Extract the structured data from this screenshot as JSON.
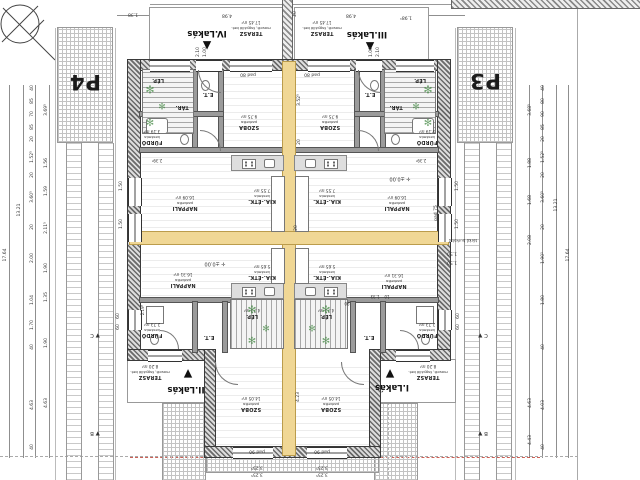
{
  "title": "Négylakásos lakóépület földszinti alaprajz (fejjel lefelé tájolt CAD rajz)",
  "parking": {
    "p4": "P4",
    "p3": "P3"
  },
  "units": [
    {
      "label": "IV.Lakás",
      "x": 207,
      "y": 33,
      "tri": "▲",
      "tx": 207,
      "ty": 46
    },
    {
      "label": "III.Lakás",
      "x": 367,
      "y": 34,
      "tri": "▲",
      "tx": 370,
      "ty": 47
    },
    {
      "label": "II.Lakás",
      "x": 186,
      "y": 389,
      "tri": "▼",
      "tx": 188,
      "ty": 374
    },
    {
      "label": "I.Lakás",
      "x": 392,
      "y": 387,
      "tri": "▼",
      "tx": 390,
      "ty": 374
    }
  ],
  "rooms": [
    {
      "name": "TERASZ",
      "mat": "mosott, fagyálló bet.",
      "area": "17.45 m²",
      "x": 251,
      "y": 28
    },
    {
      "name": "TERASZ",
      "mat": "mosott, fagyálló bet.",
      "area": "17.45 m²",
      "x": 322,
      "y": 28
    },
    {
      "name": "TERASZ",
      "mat": "mosott, fagyálló bet.",
      "area": "8.20 m²",
      "x": 150,
      "y": 372
    },
    {
      "name": "TERASZ",
      "mat": "mosott, fagyálló bet.",
      "area": "8.20 m²",
      "x": 428,
      "y": 372
    },
    {
      "name": "SZOBA",
      "mat": "parketta",
      "area": "9.75 m²",
      "x": 249,
      "y": 122
    },
    {
      "name": "SZOBA",
      "mat": "parketta",
      "area": "9.75 m²",
      "x": 330,
      "y": 122
    },
    {
      "name": "SZOBA",
      "mat": "parketta",
      "area": "14.05 m²",
      "x": 251,
      "y": 404
    },
    {
      "name": "SZOBA",
      "mat": "parketta",
      "area": "14.05 m²",
      "x": 331,
      "y": 404
    },
    {
      "name": "NAPPALI",
      "mat": "parketta",
      "area": "16.09 m²",
      "x": 185,
      "y": 203
    },
    {
      "name": "NAPPALI",
      "mat": "parketta",
      "area": "16.09 m²",
      "x": 397,
      "y": 203
    },
    {
      "name": "NAPPALI",
      "mat": "parketta",
      "area": "16.31 m²",
      "x": 183,
      "y": 280
    },
    {
      "name": "NAPPALI",
      "mat": "parketta",
      "area": "16.31 m²",
      "x": 394,
      "y": 281
    },
    {
      "name": "KIA.-ÉTK.",
      "mat": "kerámia",
      "area": "7.55 m²",
      "x": 262,
      "y": 196
    },
    {
      "name": "KIA.-ÉTK.",
      "mat": "kerámia",
      "area": "7.55 m²",
      "x": 327,
      "y": 196
    },
    {
      "name": "KIA.-ÉTK.",
      "mat": "kerámia",
      "area": "5.65 m²",
      "x": 262,
      "y": 272
    },
    {
      "name": "KIA.-ÉTK.",
      "mat": "kerámia",
      "area": "5.65 m²",
      "x": 327,
      "y": 272
    },
    {
      "name": "FÜRDŐ",
      "mat": "kerámia",
      "area": "3.19 m²",
      "x": 152,
      "y": 137
    },
    {
      "name": "FÜRDŐ",
      "mat": "kerámia",
      "area": "3.19 m²",
      "x": 427,
      "y": 137
    },
    {
      "name": "FÜRDŐ",
      "mat": "kerámia",
      "area": "2.73 m²",
      "x": 152,
      "y": 330
    },
    {
      "name": "FÜRDŐ",
      "mat": "kerámia",
      "area": "2.73 m²",
      "x": 427,
      "y": 330
    },
    {
      "name": "TÁR.",
      "mat": "",
      "area": "",
      "x": 182,
      "y": 107
    },
    {
      "name": "TÁR.",
      "mat": "",
      "area": "",
      "x": 396,
      "y": 107
    },
    {
      "name": "E.T.",
      "mat": "",
      "area": "",
      "x": 208,
      "y": 94
    },
    {
      "name": "E.T.",
      "mat": "",
      "area": "",
      "x": 370,
      "y": 94
    },
    {
      "name": "E.T.",
      "mat": "",
      "area": "",
      "x": 209,
      "y": 337
    },
    {
      "name": "E.T.",
      "mat": "",
      "area": "",
      "x": 369,
      "y": 337
    },
    {
      "name": "LÉP.",
      "mat": "",
      "area": "",
      "x": 158,
      "y": 80
    },
    {
      "name": "LÉP.",
      "mat": "",
      "area": "",
      "x": 420,
      "y": 80
    },
    {
      "name": "LÉP.",
      "mat": "",
      "area": "4.73 m²",
      "x": 252,
      "y": 313
    },
    {
      "name": "LÉP.",
      "mat": "",
      "area": "4.73 m²",
      "x": 326,
      "y": 313
    }
  ],
  "labels": [
    {
      "t": "4.98",
      "x": 227,
      "y": 14
    },
    {
      "t": "4.98",
      "x": 351,
      "y": 14
    },
    {
      "t": "1.38",
      "x": 133,
      "y": 13
    },
    {
      "t": "1.98¹",
      "x": 406,
      "y": 16
    },
    {
      "t": "20",
      "x": 296,
      "y": 14,
      "o": "v"
    },
    {
      "t": "2.10",
      "x": 199,
      "y": 52,
      "o": "v"
    },
    {
      "t": "1.00",
      "x": 206,
      "y": 52,
      "o": "v"
    },
    {
      "t": "2.10",
      "x": 379,
      "y": 52,
      "o": "v"
    },
    {
      "t": "1.00",
      "x": 372,
      "y": 52,
      "o": "v"
    },
    {
      "t": "pad 80",
      "x": 248,
      "y": 73
    },
    {
      "t": "pad 80",
      "x": 312,
      "y": 73
    },
    {
      "t": "pad 90",
      "x": 257,
      "y": 450
    },
    {
      "t": "pad 90",
      "x": 322,
      "y": 450
    },
    {
      "t": "3.25⁵",
      "x": 257,
      "y": 466
    },
    {
      "t": "3.25⁵",
      "x": 257,
      "y": 473
    },
    {
      "t": "3.25⁵",
      "x": 322,
      "y": 466
    },
    {
      "t": "3.25⁵",
      "x": 322,
      "y": 473
    },
    {
      "t": "1.50",
      "x": 122,
      "y": 186,
      "o": "v"
    },
    {
      "t": "1.50",
      "x": 122,
      "y": 224,
      "o": "v"
    },
    {
      "t": "1.50",
      "x": 458,
      "y": 186,
      "o": "v"
    },
    {
      "t": "1.50",
      "x": 458,
      "y": 224,
      "o": "v"
    },
    {
      "t": "1.50",
      "x": 452,
      "y": 252
    },
    {
      "t": "1.50",
      "x": 452,
      "y": 261
    },
    {
      "t": "60",
      "x": 119,
      "y": 316,
      "o": "v"
    },
    {
      "t": "60",
      "x": 119,
      "y": 327,
      "o": "v"
    },
    {
      "t": "60",
      "x": 459,
      "y": 316,
      "o": "v"
    },
    {
      "t": "60",
      "x": 459,
      "y": 327,
      "o": "v"
    },
    {
      "t": "3.52⁵",
      "x": 300,
      "y": 100,
      "o": "v"
    },
    {
      "t": "20",
      "x": 300,
      "y": 142,
      "o": "v"
    },
    {
      "t": "4.23",
      "x": 299,
      "y": 397,
      "o": "v"
    },
    {
      "t": "20",
      "x": 297,
      "y": 228,
      "o": "v"
    },
    {
      "t": "✛ ±0.00",
      "x": 215,
      "y": 263,
      "s": 5
    },
    {
      "t": "✛ ±0.00",
      "x": 400,
      "y": 178,
      "s": 5
    },
    {
      "t": "térkő burkolat",
      "x": 463,
      "y": 240,
      "s": 4
    },
    {
      "t": "pad 75",
      "x": 437,
      "y": 213,
      "o": "v"
    },
    {
      "t": "1.33",
      "x": 375,
      "y": 296,
      "s": 4
    },
    {
      "t": "10",
      "x": 387,
      "y": 296,
      "s": 4
    },
    {
      "t": "90",
      "x": 347,
      "y": 303,
      "s": 4
    },
    {
      "t": "2.39⁵",
      "x": 421,
      "y": 160,
      "s": 4
    },
    {
      "t": "2.39⁵",
      "x": 157,
      "y": 160,
      "s": 4
    },
    {
      "t": "2.19⁵",
      "x": 143,
      "y": 310,
      "o": "v",
      "s": 4
    },
    {
      "t": "▼ C",
      "x": 95,
      "y": 334,
      "s": 5.5
    },
    {
      "t": "▼ B",
      "x": 95,
      "y": 432,
      "s": 5.5
    },
    {
      "t": "C ▼",
      "x": 483,
      "y": 334,
      "s": 5.5
    },
    {
      "t": "B ▼",
      "x": 483,
      "y": 432,
      "s": 5.5
    },
    {
      "t": "40",
      "x": 33,
      "y": 88,
      "o": "v"
    },
    {
      "t": "85",
      "x": 33,
      "y": 101,
      "o": "v"
    },
    {
      "t": "70",
      "x": 33,
      "y": 114,
      "o": "v"
    },
    {
      "t": "85",
      "x": 33,
      "y": 127,
      "o": "v"
    },
    {
      "t": "20",
      "x": 33,
      "y": 139,
      "o": "v"
    },
    {
      "t": "1.52⁵",
      "x": 33,
      "y": 157,
      "o": "v"
    },
    {
      "t": "20",
      "x": 33,
      "y": 175,
      "o": "v"
    },
    {
      "t": "3.60⁵",
      "x": 33,
      "y": 197,
      "o": "v"
    },
    {
      "t": "20",
      "x": 33,
      "y": 227,
      "o": "v"
    },
    {
      "t": "2.00",
      "x": 33,
      "y": 258,
      "o": "v"
    },
    {
      "t": "1.04",
      "x": 33,
      "y": 300,
      "o": "v"
    },
    {
      "t": "1.70",
      "x": 33,
      "y": 325,
      "o": "v"
    },
    {
      "t": "40",
      "x": 33,
      "y": 347,
      "o": "v"
    },
    {
      "t": "4.63",
      "x": 33,
      "y": 405,
      "o": "v"
    },
    {
      "t": "40",
      "x": 33,
      "y": 447,
      "o": "v"
    },
    {
      "t": "3.69⁵",
      "x": 47,
      "y": 110,
      "o": "v"
    },
    {
      "t": "1.56",
      "x": 47,
      "y": 163,
      "o": "v"
    },
    {
      "t": "1.59",
      "x": 47,
      "y": 191,
      "o": "v"
    },
    {
      "t": "2.11⁵",
      "x": 47,
      "y": 228,
      "o": "v"
    },
    {
      "t": "1.90",
      "x": 47,
      "y": 268,
      "o": "v"
    },
    {
      "t": "1.35",
      "x": 47,
      "y": 297,
      "o": "v"
    },
    {
      "t": "1.90",
      "x": 47,
      "y": 343,
      "o": "v"
    },
    {
      "t": "4.63",
      "x": 47,
      "y": 403,
      "o": "v"
    },
    {
      "t": "13.21",
      "x": 20,
      "y": 210,
      "o": "v"
    },
    {
      "t": "17.64",
      "x": 6,
      "y": 255,
      "o": "v"
    },
    {
      "t": "40",
      "x": 544,
      "y": 88,
      "o": "v"
    },
    {
      "t": "80",
      "x": 544,
      "y": 101,
      "o": "v"
    },
    {
      "t": "90",
      "x": 544,
      "y": 114,
      "o": "v"
    },
    {
      "t": "85",
      "x": 544,
      "y": 127,
      "o": "v"
    },
    {
      "t": "20",
      "x": 544,
      "y": 139,
      "o": "v"
    },
    {
      "t": "1.52⁵",
      "x": 544,
      "y": 157,
      "o": "v"
    },
    {
      "t": "20",
      "x": 544,
      "y": 175,
      "o": "v"
    },
    {
      "t": "3.60⁵",
      "x": 544,
      "y": 197,
      "o": "v"
    },
    {
      "t": "20",
      "x": 544,
      "y": 227,
      "o": "v"
    },
    {
      "t": "1.90¹",
      "x": 544,
      "y": 258,
      "o": "v"
    },
    {
      "t": "1.80",
      "x": 544,
      "y": 300,
      "o": "v"
    },
    {
      "t": "40",
      "x": 544,
      "y": 347,
      "o": "v"
    },
    {
      "t": "4.03",
      "x": 544,
      "y": 405,
      "o": "v"
    },
    {
      "t": "40",
      "x": 544,
      "y": 447,
      "o": "v"
    },
    {
      "t": "3.68⁵",
      "x": 531,
      "y": 110,
      "o": "v"
    },
    {
      "t": "1.88",
      "x": 531,
      "y": 163,
      "o": "v"
    },
    {
      "t": "1.68",
      "x": 531,
      "y": 200,
      "o": "v"
    },
    {
      "t": "2.08",
      "x": 531,
      "y": 240,
      "o": "v"
    },
    {
      "t": "4.63",
      "x": 531,
      "y": 403,
      "o": "v"
    },
    {
      "t": "4.43",
      "x": 531,
      "y": 440,
      "o": "v"
    },
    {
      "t": "13.21",
      "x": 557,
      "y": 205,
      "o": "v"
    },
    {
      "t": "17.64",
      "x": 569,
      "y": 255,
      "o": "v"
    }
  ],
  "plants": [
    {
      "x": 150,
      "y": 90,
      "s": 11
    },
    {
      "x": 162,
      "y": 108,
      "s": 9
    },
    {
      "x": 150,
      "y": 124,
      "s": 10
    },
    {
      "x": 428,
      "y": 90,
      "s": 11
    },
    {
      "x": 416,
      "y": 108,
      "s": 9
    },
    {
      "x": 428,
      "y": 124,
      "s": 10
    },
    {
      "x": 252,
      "y": 310,
      "s": 11
    },
    {
      "x": 266,
      "y": 330,
      "s": 9
    },
    {
      "x": 252,
      "y": 342,
      "s": 10
    },
    {
      "x": 326,
      "y": 310,
      "s": 11
    },
    {
      "x": 312,
      "y": 330,
      "s": 9
    },
    {
      "x": 326,
      "y": 342,
      "s": 10
    }
  ],
  "icons": {
    "plant_glyph": "✻",
    "compass": "north-compass"
  },
  "colors": {
    "party_wall": "#f0d795",
    "red_line": "#c0392b",
    "plant": "#4e8f4e"
  }
}
